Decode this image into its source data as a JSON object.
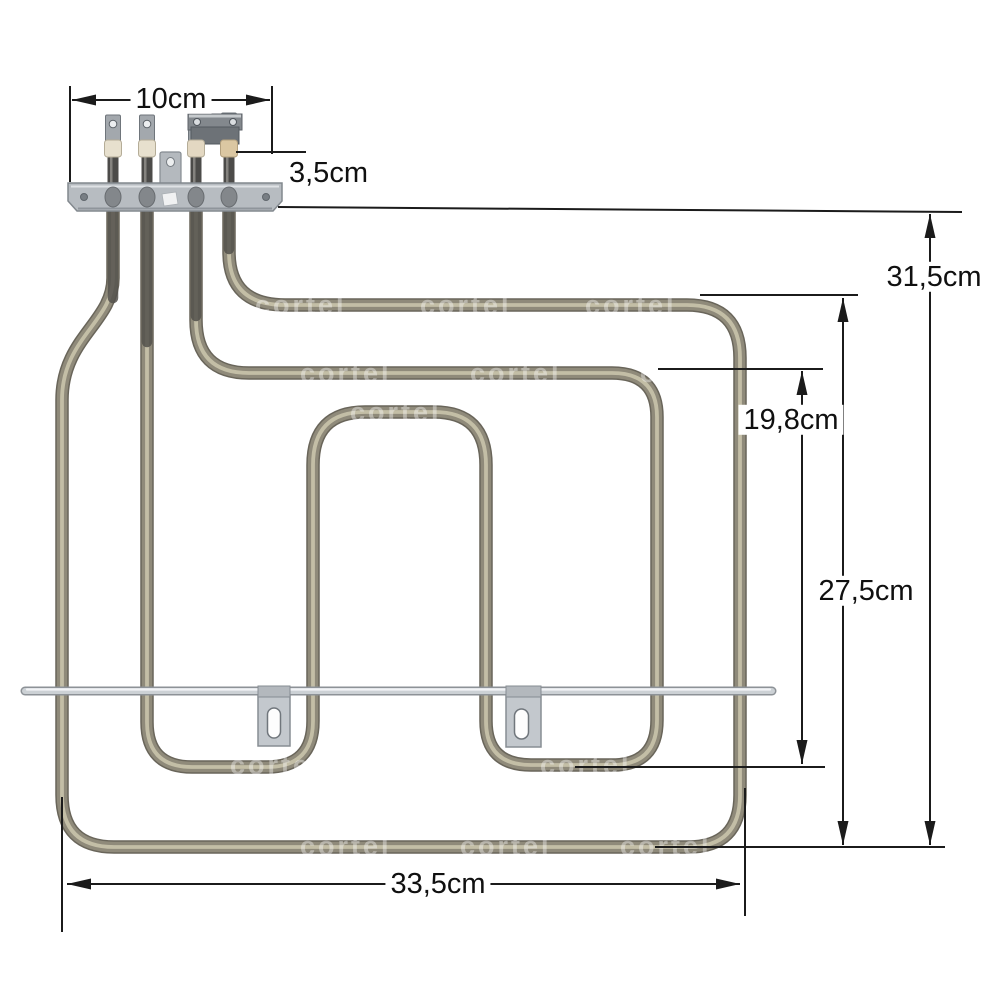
{
  "figure": {
    "background_color": "#ffffff",
    "watermark_text": "cortel",
    "subject": "oven grill heating element with mounting bracket, four spade terminals, bridged terminal pair, support rod and two mounting tabs"
  },
  "dimension_labels": {
    "terminal_width": "10cm",
    "terminal_to_bracket_offset": "3,5cm",
    "total_height": "31,5cm",
    "inner_loop_height": "19,8cm",
    "outer_loop_height": "27,5cm",
    "total_width": "33,5cm"
  },
  "colors": {
    "tube_edge": "#69655a",
    "tube_base": "#8f8a7a",
    "tube_highlight": "#c9c3ab",
    "support_rod": "#ccd1d5",
    "bracket_plate": "#b7bcc1",
    "terminal_pin": "#4c4b49",
    "ceramic_bead": "#e7e0ce",
    "annotation": "#1b1b1b"
  }
}
